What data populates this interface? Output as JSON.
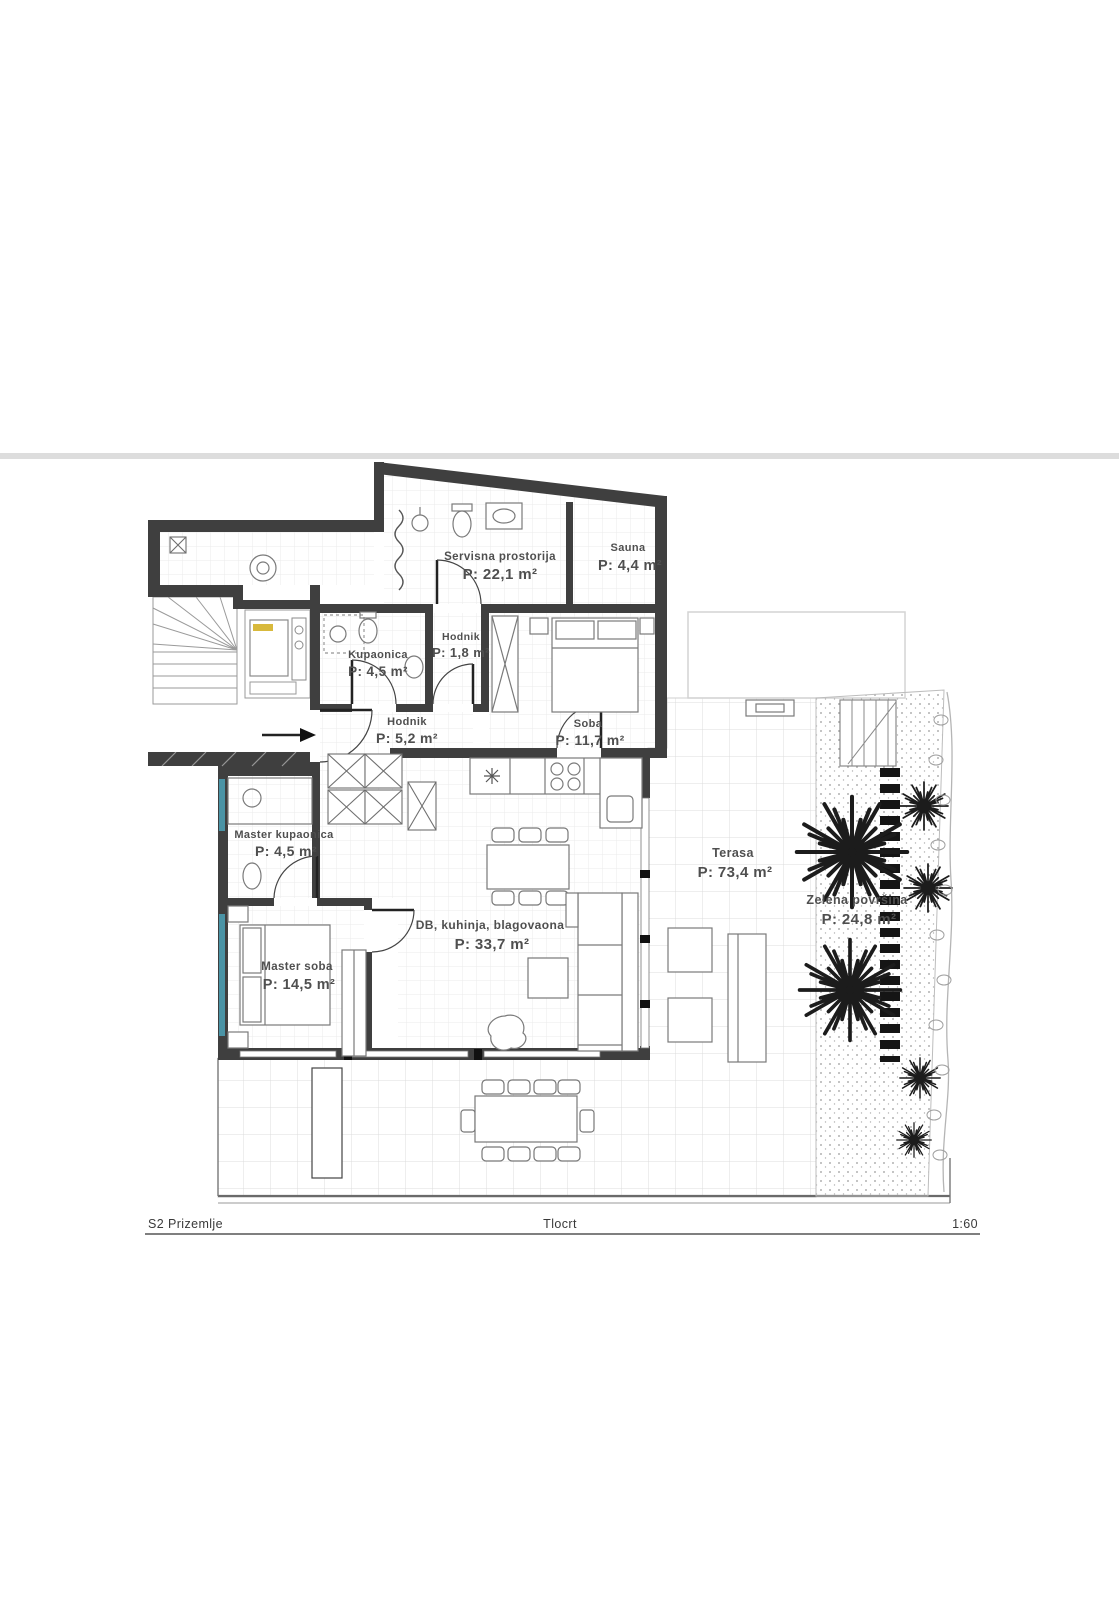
{
  "footer": {
    "left_label": "S2 Prizemlje",
    "center_label": "Tlocrt",
    "scale_label": "1:60"
  },
  "rooms": [
    {
      "id": "servisna",
      "name": "Servisna prostorija",
      "area": "P: 22,1 m²"
    },
    {
      "id": "sauna",
      "name": "Sauna",
      "area": "P: 4,4 m²"
    },
    {
      "id": "kupaonica",
      "name": "Kupaonica",
      "area": "P: 4,5 m²"
    },
    {
      "id": "hodnik-mali",
      "name": "Hodnik",
      "area": "P: 1,8 m²"
    },
    {
      "id": "hodnik",
      "name": "Hodnik",
      "area": "P: 5,2 m²"
    },
    {
      "id": "soba",
      "name": "Soba",
      "area": "P: 11,7 m²"
    },
    {
      "id": "master-kupaonica",
      "name": "Master kupaonica",
      "area": "P: 4,5 m²"
    },
    {
      "id": "master-soba",
      "name": "Master soba",
      "area": "P: 14,5 m²"
    },
    {
      "id": "dnevni",
      "name": "DB, kuhinja, blagovaona",
      "area": "P: 33,7 m²"
    },
    {
      "id": "terasa",
      "name": "Terasa",
      "area": "P: 73,4 m²"
    },
    {
      "id": "zelena",
      "name": "Zelena površina",
      "area": "P: 24,8 m²"
    }
  ],
  "colors": {
    "wall": "#3f3f3f",
    "window_accent": "#4a93a5",
    "equipment_highlight": "#d8b93c",
    "label_text": "#4f4f4f",
    "page_divider": "#dddddd"
  }
}
